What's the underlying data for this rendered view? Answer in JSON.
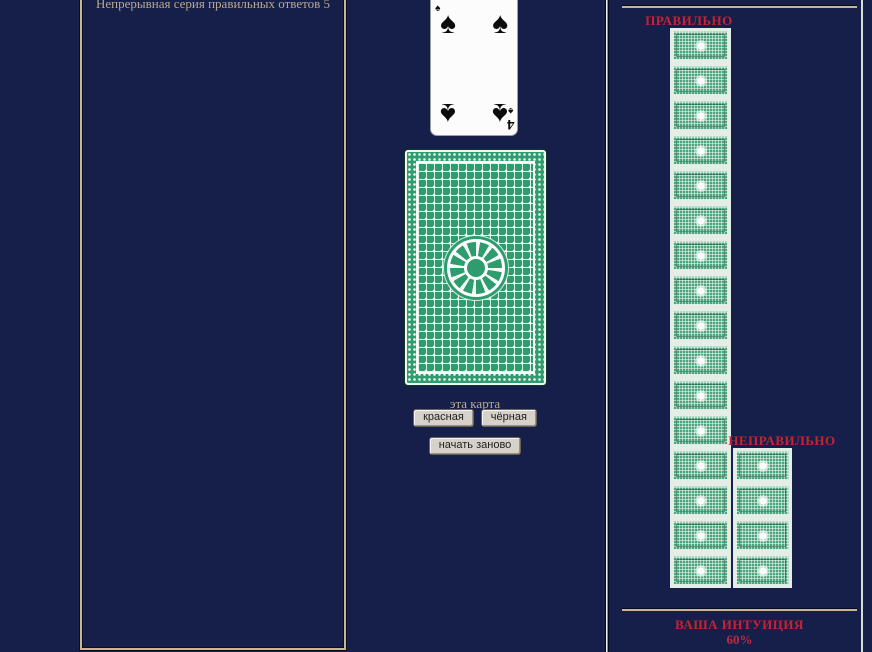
{
  "window": {
    "width": 872,
    "height": 652
  },
  "colors": {
    "background": "#151f4a",
    "panel_border_tan": "#c7b593",
    "muted_tan_text": "#b9a88a",
    "label_red": "#cd2133",
    "card_back_green": "#2e9c6d",
    "mini_card_green": "#4ea67e",
    "button_face": "#d6d2c9"
  },
  "left_panel": {
    "streak_text": "Непрерывная серия правильных ответов 5"
  },
  "center": {
    "revealed_card": {
      "rank": "4",
      "suit": "spades",
      "suit_symbol": "♠",
      "color": "black"
    },
    "card_back_label": "эта карта",
    "buttons": {
      "red": "красная",
      "black": "чёрная",
      "restart": "начать заново"
    }
  },
  "right_panel": {
    "correct": {
      "label": "ПРАВИЛЬНО",
      "count": 16
    },
    "incorrect": {
      "label": "НЕПРАВИЛЬНО",
      "count": 4
    },
    "intuition": {
      "label": "ВАША ИНТУИЦИЯ",
      "value": "60%"
    }
  }
}
